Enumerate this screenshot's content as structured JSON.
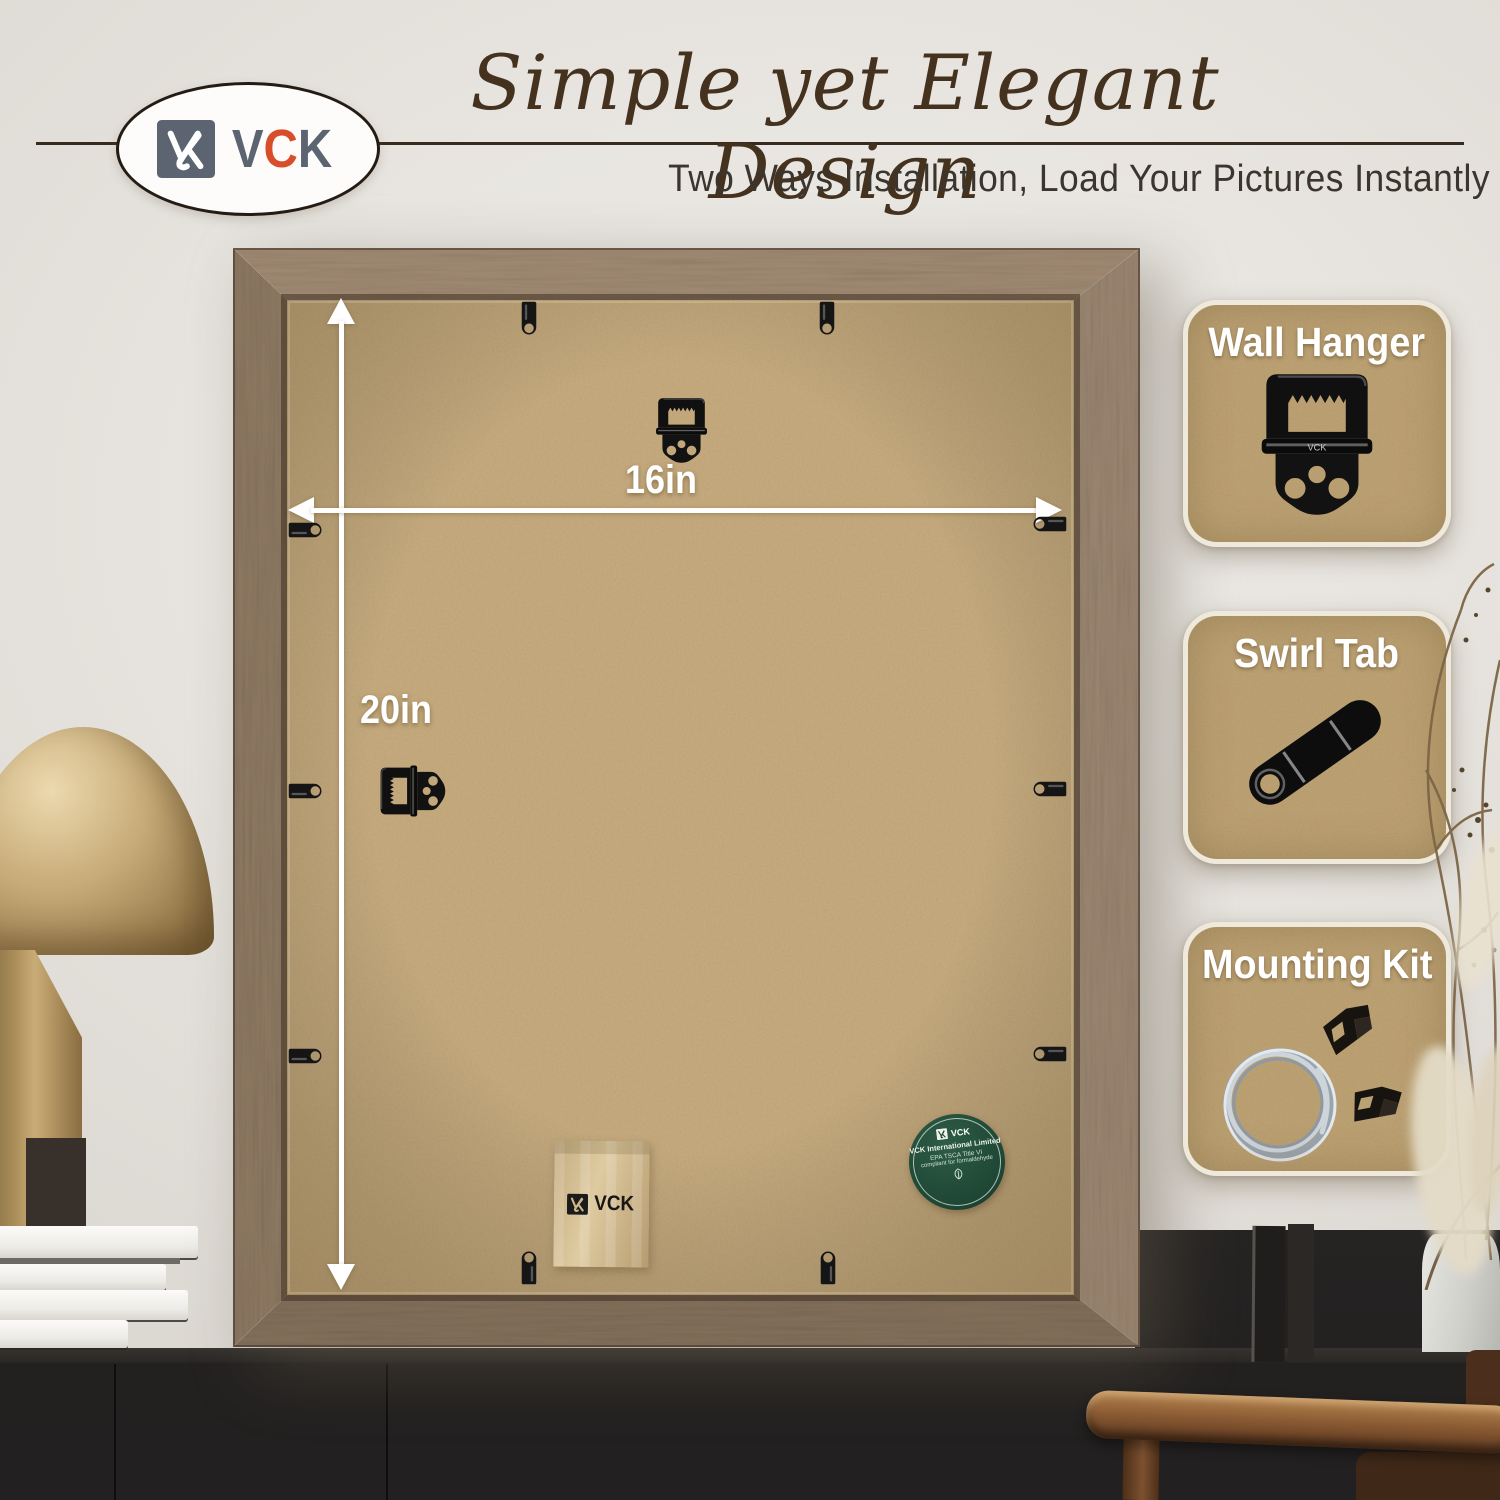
{
  "brand": {
    "name": "VCK",
    "letters": [
      "V",
      "C",
      "K"
    ]
  },
  "header": {
    "title": "Simple yet Elegant Design",
    "subtitle": "Two Ways Installation, Load Your Pictures Instantly"
  },
  "dimensions": {
    "width": "16in",
    "height": "20in"
  },
  "callouts": [
    {
      "label": "Wall Hanger"
    },
    {
      "label": "Swirl Tab"
    },
    {
      "label": "Mounting Kit"
    }
  ],
  "sticker": {
    "brand": "VCK",
    "company": "VCK International Limited",
    "cert1": "EPA TSCA Title VI",
    "cert2": "compliant for formaldehyde"
  },
  "envelope": {
    "brand": "VCK"
  },
  "colors": {
    "accent_red": "#d94e2a",
    "logo_gray": "#5b6470",
    "title_brown": "#44321f",
    "kraft": "#c6ab7e",
    "wood": "#8e7962",
    "sticker_green": "#1e4634",
    "wall": "#e7e4df",
    "arrow_white": "#ffffff"
  }
}
